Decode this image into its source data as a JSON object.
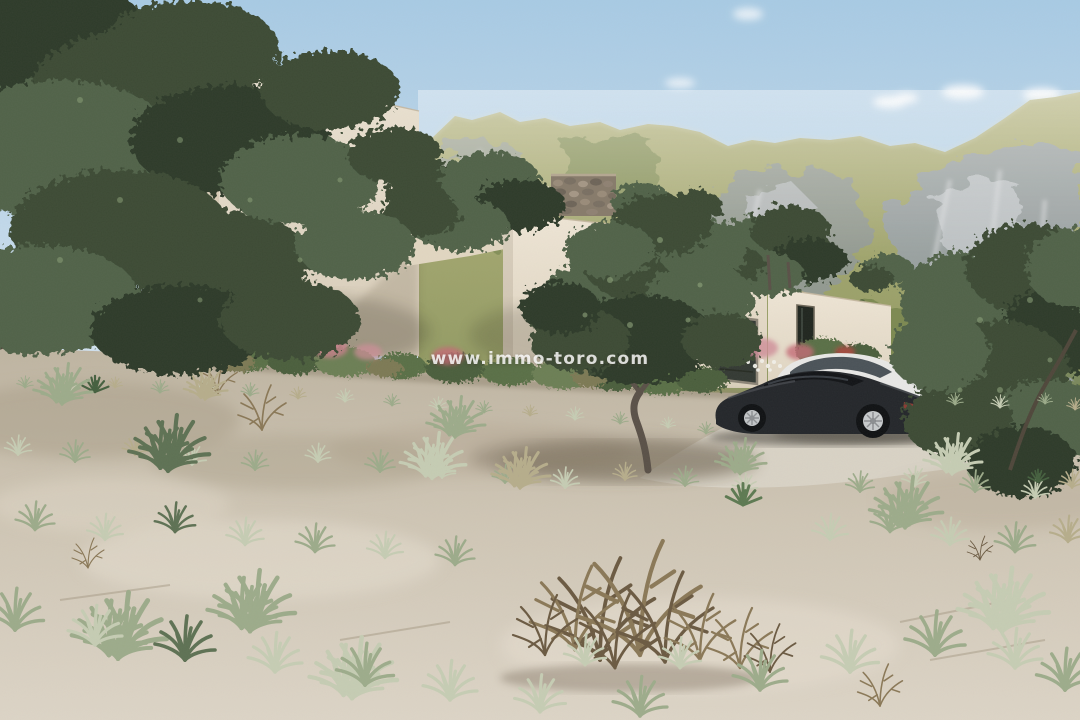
{
  "watermark": {
    "text": "www.immo-toro.com"
  },
  "palette": {
    "sky_top": "#a8cbe5",
    "sky_horizon": "#e0ecf4",
    "cloud": "#ffffff",
    "mountain_grass_top": "#b4b37b",
    "mountain_grass_bottom": "#87935c",
    "mountain_rock": "#99a1aa",
    "mountain_rock_light": "#c6cacd",
    "wall_lit": "#ece3d3",
    "wall_lit_low": "#d8cdb9",
    "wall_side": "#d8ccb7",
    "overhang_shadow": "#5b5244",
    "stone_wall": "#877b6b",
    "garage_door": "#343a34",
    "window_dark": "#20261f",
    "sand_far": "#bfb5a2",
    "sand_near": "#ddd5c7",
    "driveway": "#d9d3c6",
    "foliage_dark": "#3c4c36",
    "foliage_light": "#66785a",
    "grass_pale": "#c6cdb4",
    "pink_flower": "#d08d99",
    "dead_bush": "#6b5a42",
    "car_dark": "#24272b",
    "car_white": "#e9e9e7",
    "watermark_color": "rgba(255,255,255,0.82)"
  }
}
